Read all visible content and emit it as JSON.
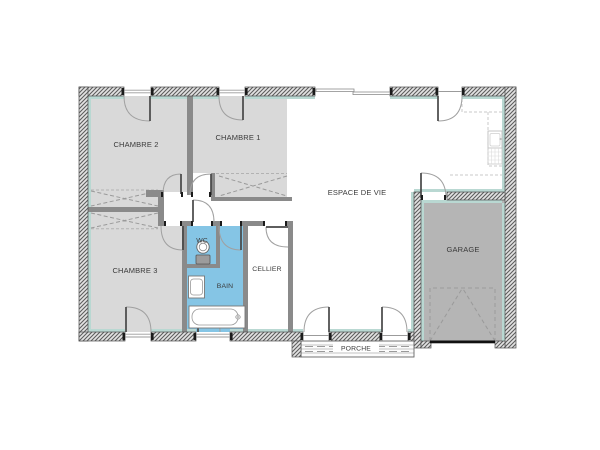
{
  "floorplan": {
    "rooms": {
      "chambre2": {
        "label": "CHAMBRE 2"
      },
      "chambre1": {
        "label": "CHAMBRE 1"
      },
      "chambre3": {
        "label": "CHAMBRE 3"
      },
      "wc": {
        "label": "WC"
      },
      "bain": {
        "label": "BAIN"
      },
      "cellier": {
        "label": "CELLIER"
      },
      "espace_de_vie": {
        "label": "ESPACE DE VIE"
      },
      "garage": {
        "label": "GARAGE"
      },
      "porche": {
        "label": "PORCHE"
      }
    },
    "colors": {
      "room_fill_gray": "#d9d9d9",
      "garage_fill_gray": "#b5b5b5",
      "bath_fill_blue": "#85c5e5",
      "insulation_teal": "#b9d8d2",
      "interior_wall_gray": "#8a8a8a",
      "label_text": "#3a3a3a"
    },
    "fixtures": [
      "toilet",
      "washbasin",
      "bathtub",
      "kitchen-sink",
      "kitchen-counter",
      "wardrobe",
      "garage-door",
      "porch-deck",
      "swing-door",
      "window"
    ]
  }
}
